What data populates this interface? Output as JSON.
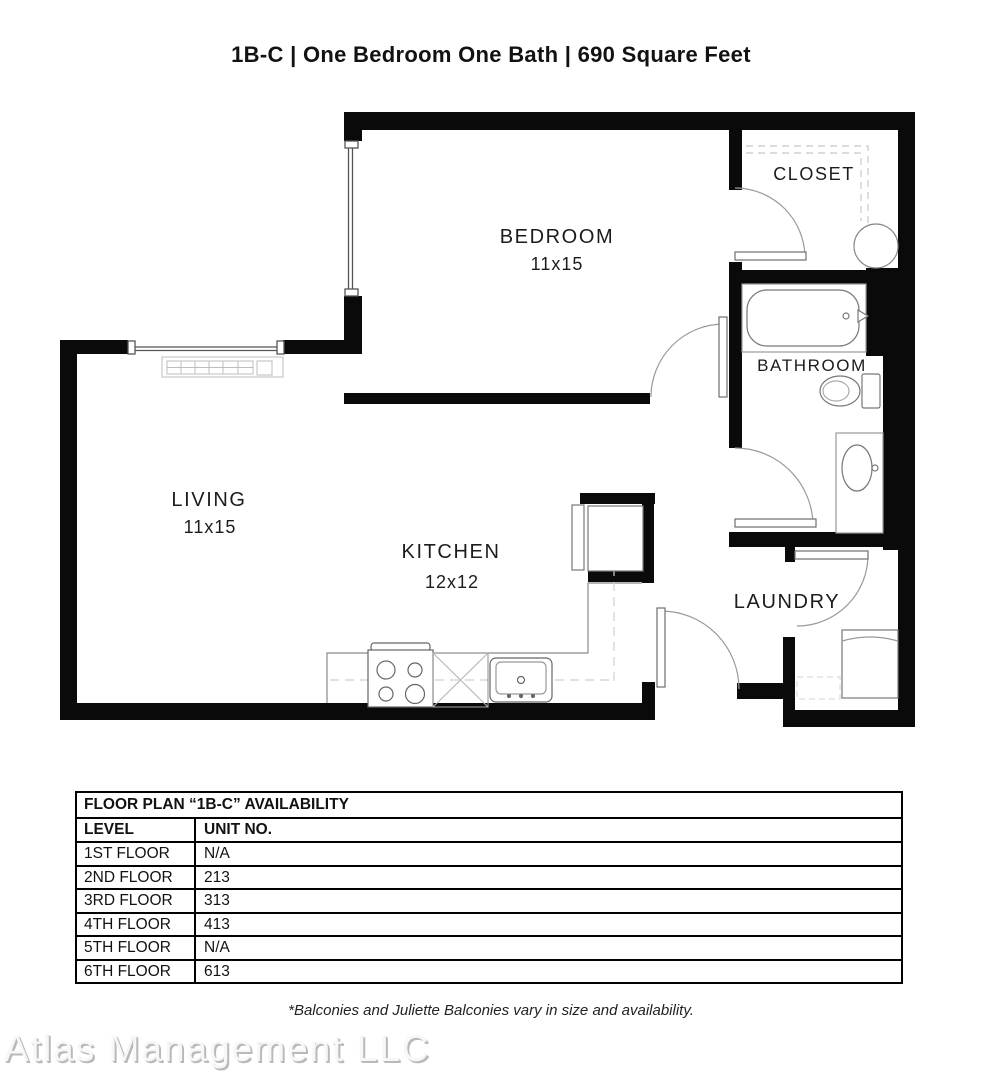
{
  "header": {
    "title": "1B-C  | One Bedroom One Bath |  690 Square Feet"
  },
  "plan": {
    "rooms": {
      "bedroom": {
        "name": "BEDROOM",
        "dims": "11x15"
      },
      "living": {
        "name": "LIVING",
        "dims": "11x15"
      },
      "kitchen": {
        "name": "KITCHEN",
        "dims": "12x12"
      },
      "closet": {
        "name": "CLOSET"
      },
      "bathroom": {
        "name": "BATHROOM"
      },
      "laundry": {
        "name": "LAUNDRY"
      }
    },
    "fixtures": [
      "bathtub",
      "toilet",
      "vanity-sink",
      "water-heater",
      "washer-dryer",
      "refrigerator",
      "range-stove",
      "dishwasher",
      "kitchen-sink",
      "baseboard-heater",
      "closet-shelving"
    ],
    "colors": {
      "wall": "#0a0a0a",
      "fixture_line": "#8a8a8a",
      "dashed_line": "#c8c8c8",
      "label": "#1c1c1c"
    }
  },
  "availability_table": {
    "title": "FLOOR PLAN “1B-C” AVAILABILITY",
    "columns": [
      "LEVEL",
      "UNIT NO."
    ],
    "rows": [
      {
        "level": "1ST FLOOR",
        "unit": "N/A"
      },
      {
        "level": "2ND FLOOR",
        "unit": "213"
      },
      {
        "level": "3RD FLOOR",
        "unit": "313"
      },
      {
        "level": "4TH FLOOR",
        "unit": "413"
      },
      {
        "level": "5TH FLOOR",
        "unit": "N/A"
      },
      {
        "level": "6TH FLOOR",
        "unit": "613"
      }
    ]
  },
  "footnote": "*Balconies and Juliette Balconies vary in size and availability.",
  "watermark": "Atlas Management LLC"
}
